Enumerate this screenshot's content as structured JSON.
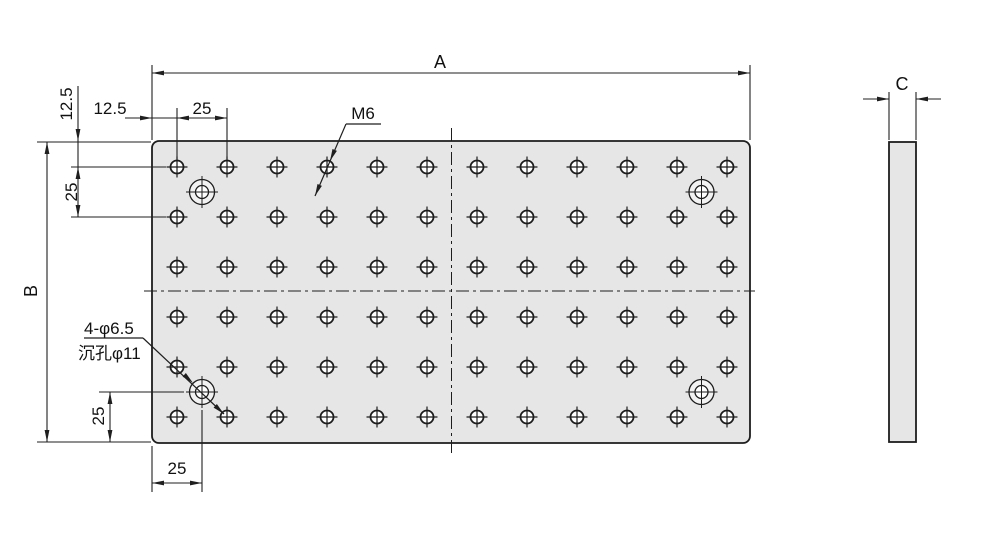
{
  "labels": {
    "a": "A",
    "b": "B",
    "c": "C"
  },
  "dims": {
    "h125": {
      "label": "12.5"
    },
    "v125": {
      "label": "12.5"
    },
    "h25_top": {
      "label": "25"
    },
    "v25_top": {
      "label": "25"
    },
    "v25_bottom": {
      "label": "25"
    },
    "h25_bottom": {
      "label": "25"
    }
  },
  "callouts": {
    "thread": {
      "text": "M6"
    },
    "cbore": {
      "line1": "4-φ6.5",
      "line2": "沉孔φ11"
    }
  },
  "geometry": {
    "colors": {
      "line": "#1d1d1d",
      "dim": "#1f1f1f",
      "plate_fill": "#e6e6e6",
      "hole_fill": "#ffffff",
      "cbore_fill": "#f2f2f2",
      "bg": "#ffffff"
    },
    "plate": {
      "x": 152,
      "y": 141,
      "w": 598,
      "h": 302,
      "corner": 7
    },
    "side_view": {
      "x": 889,
      "y": 142,
      "w": 27,
      "h": 300
    },
    "grid": {
      "cols": 12,
      "rows": 6,
      "x0": 177,
      "y0": 167,
      "dx": 50,
      "dy": 50,
      "r": 6.5,
      "cross": 10.5
    },
    "cbores": {
      "centers": [
        [
          202,
          192
        ],
        [
          701.5,
          192
        ],
        [
          202,
          392
        ],
        [
          701.5,
          392
        ]
      ],
      "r_outer": 12.5,
      "r_inner": 6.5,
      "cross": 16
    },
    "centerlines": [
      [
        144,
        291,
        755,
        291
      ],
      [
        451.5,
        128,
        451.5,
        457
      ]
    ],
    "ext_lines": [
      [
        152,
        65,
        152,
        140
      ],
      [
        750,
        65,
        750,
        140
      ],
      [
        37,
        142,
        151,
        142
      ],
      [
        37,
        442,
        151,
        442
      ],
      [
        177,
        108,
        177,
        160
      ],
      [
        227,
        108,
        227,
        160
      ],
      [
        71,
        167,
        166,
        167
      ],
      [
        71,
        217,
        166,
        217
      ],
      [
        99,
        392,
        184,
        392
      ],
      [
        152,
        446,
        152,
        492
      ],
      [
        202,
        410,
        202,
        492
      ],
      [
        889,
        92,
        889,
        140
      ],
      [
        916,
        92,
        916,
        140
      ]
    ],
    "dim_lines": [
      [
        152,
        73,
        750,
        73
      ],
      [
        47,
        142,
        47,
        442
      ],
      [
        125,
        118,
        227,
        118
      ],
      [
        78,
        86,
        78,
        217
      ],
      [
        110,
        392,
        110,
        442
      ],
      [
        152,
        483,
        202,
        483
      ],
      [
        863,
        99,
        889,
        99
      ],
      [
        916,
        99,
        941,
        99
      ]
    ],
    "arrows": [
      [
        152,
        73,
        180
      ],
      [
        750,
        73,
        0
      ],
      [
        47,
        142,
        -90
      ],
      [
        47,
        442,
        90
      ],
      [
        152,
        118,
        0
      ],
      [
        177,
        118,
        180
      ],
      [
        227,
        118,
        0
      ],
      [
        78,
        141,
        90
      ],
      [
        78,
        167,
        -90
      ],
      [
        78,
        217,
        90
      ],
      [
        110,
        392,
        -90
      ],
      [
        110,
        442,
        90
      ],
      [
        152,
        483,
        180
      ],
      [
        202,
        483,
        0
      ],
      [
        889,
        99,
        0
      ],
      [
        916,
        99,
        180
      ]
    ],
    "leaders": [
      {
        "underline": [
          346,
          124,
          381,
          124
        ],
        "line": [
          346,
          124,
          315,
          196
        ],
        "arrows": [
          [
            330,
            161,
            113
          ],
          [
            315,
            196,
            113
          ]
        ]
      },
      {
        "underline": [
          84,
          338,
          143,
          338
        ],
        "line": [
          143,
          338,
          224,
          414
        ],
        "arrows": [
          [
            193,
            383,
            43
          ],
          [
            224,
            414,
            43
          ]
        ]
      }
    ]
  }
}
